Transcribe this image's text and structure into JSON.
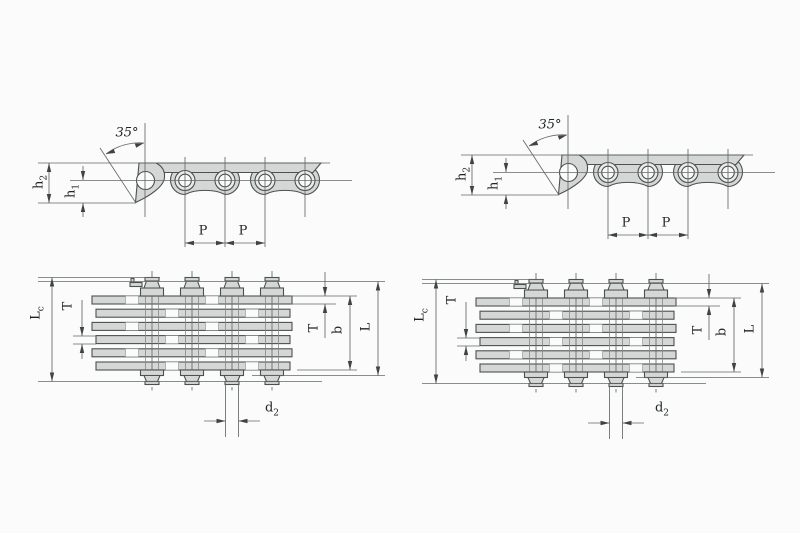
{
  "page": {
    "background_color": "#fbfbfb",
    "description": "Engineering dimension drawing of leaf chains: two chain variants side by side, each shown as a side elevation view (top) and a stacked-plate plan view (bottom) with dimension callouts"
  },
  "labels": {
    "angle": "35°",
    "h2": {
      "base": "h",
      "sub": "2"
    },
    "h1": {
      "base": "h",
      "sub": "1"
    },
    "pitch": "P",
    "lc": {
      "base": "L",
      "sub": "c"
    },
    "t": "T",
    "b": "b",
    "l": "L",
    "d2": {
      "base": "d",
      "sub": "2"
    }
  },
  "panels": [
    {
      "name": "left-chain",
      "views": [
        "side-view",
        "plan-view"
      ],
      "dimension_labels": [
        "35°",
        "h2",
        "h1",
        "P",
        "P",
        "Lc",
        "T",
        "T",
        "b",
        "L",
        "d2"
      ]
    },
    {
      "name": "right-chain",
      "views": [
        "side-view",
        "plan-view"
      ],
      "dimension_labels": [
        "35°",
        "h2",
        "h1",
        "P",
        "P",
        "Lc",
        "T",
        "T",
        "b",
        "L",
        "d2"
      ]
    }
  ],
  "colors": {
    "plate_fill": "#d5d7d6",
    "outline": "#4b514e",
    "dimension_lines": "#636866",
    "label_text": "#1f2523"
  }
}
